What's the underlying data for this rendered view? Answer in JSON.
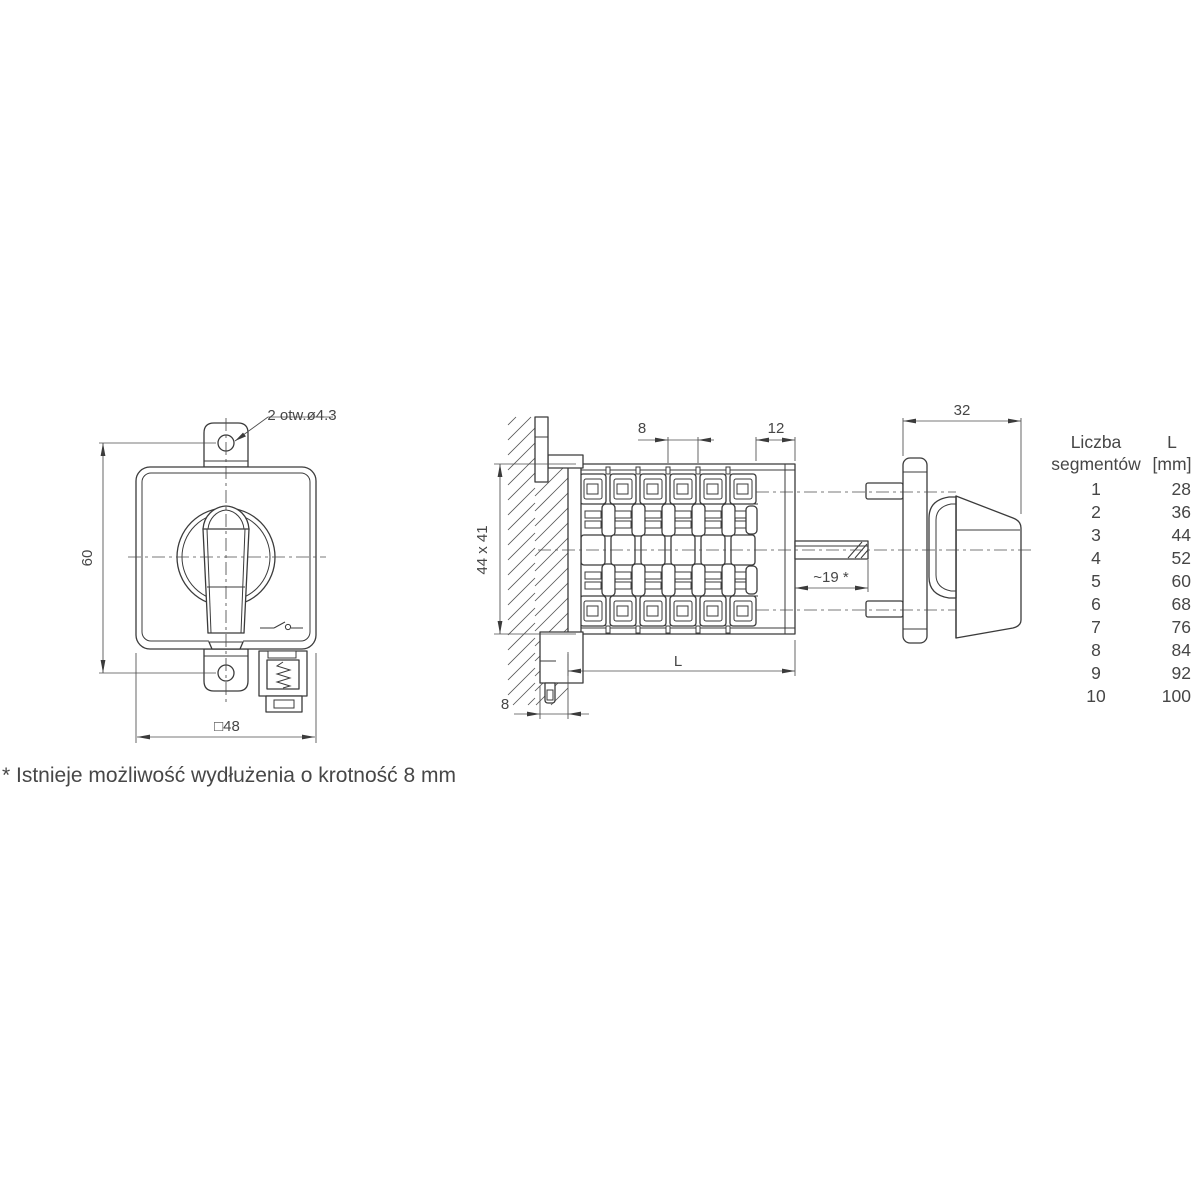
{
  "colors": {
    "line": "#3b3b3b",
    "text": "#464646"
  },
  "front_view": {
    "holes_note": "2 otw.ø4.3",
    "dim_height": "60",
    "dim_width": "□48"
  },
  "side_view": {
    "dim_segment_pitch": "8",
    "dim_end_section": "12",
    "dim_mounting_square": "44 x 41",
    "dim_length": "L",
    "dim_bottom_offset": "8",
    "dim_shaft_length": "~19 *"
  },
  "handle_view": {
    "dim_depth": "32"
  },
  "table": {
    "header": {
      "col1_line1": "Liczba",
      "col1_line2": "segmentów",
      "col2_line1": "L",
      "col2_line2": "[mm]"
    },
    "rows": [
      {
        "segments": "1",
        "l_mm": "28"
      },
      {
        "segments": "2",
        "l_mm": "36"
      },
      {
        "segments": "3",
        "l_mm": "44"
      },
      {
        "segments": "4",
        "l_mm": "52"
      },
      {
        "segments": "5",
        "l_mm": "60"
      },
      {
        "segments": "6",
        "l_mm": "68"
      },
      {
        "segments": "7",
        "l_mm": "76"
      },
      {
        "segments": "8",
        "l_mm": "84"
      },
      {
        "segments": "9",
        "l_mm": "92"
      },
      {
        "segments": "10",
        "l_mm": "100"
      }
    ]
  },
  "footnote": "* Istnieje możliwość wydłużenia o krotność 8 mm"
}
